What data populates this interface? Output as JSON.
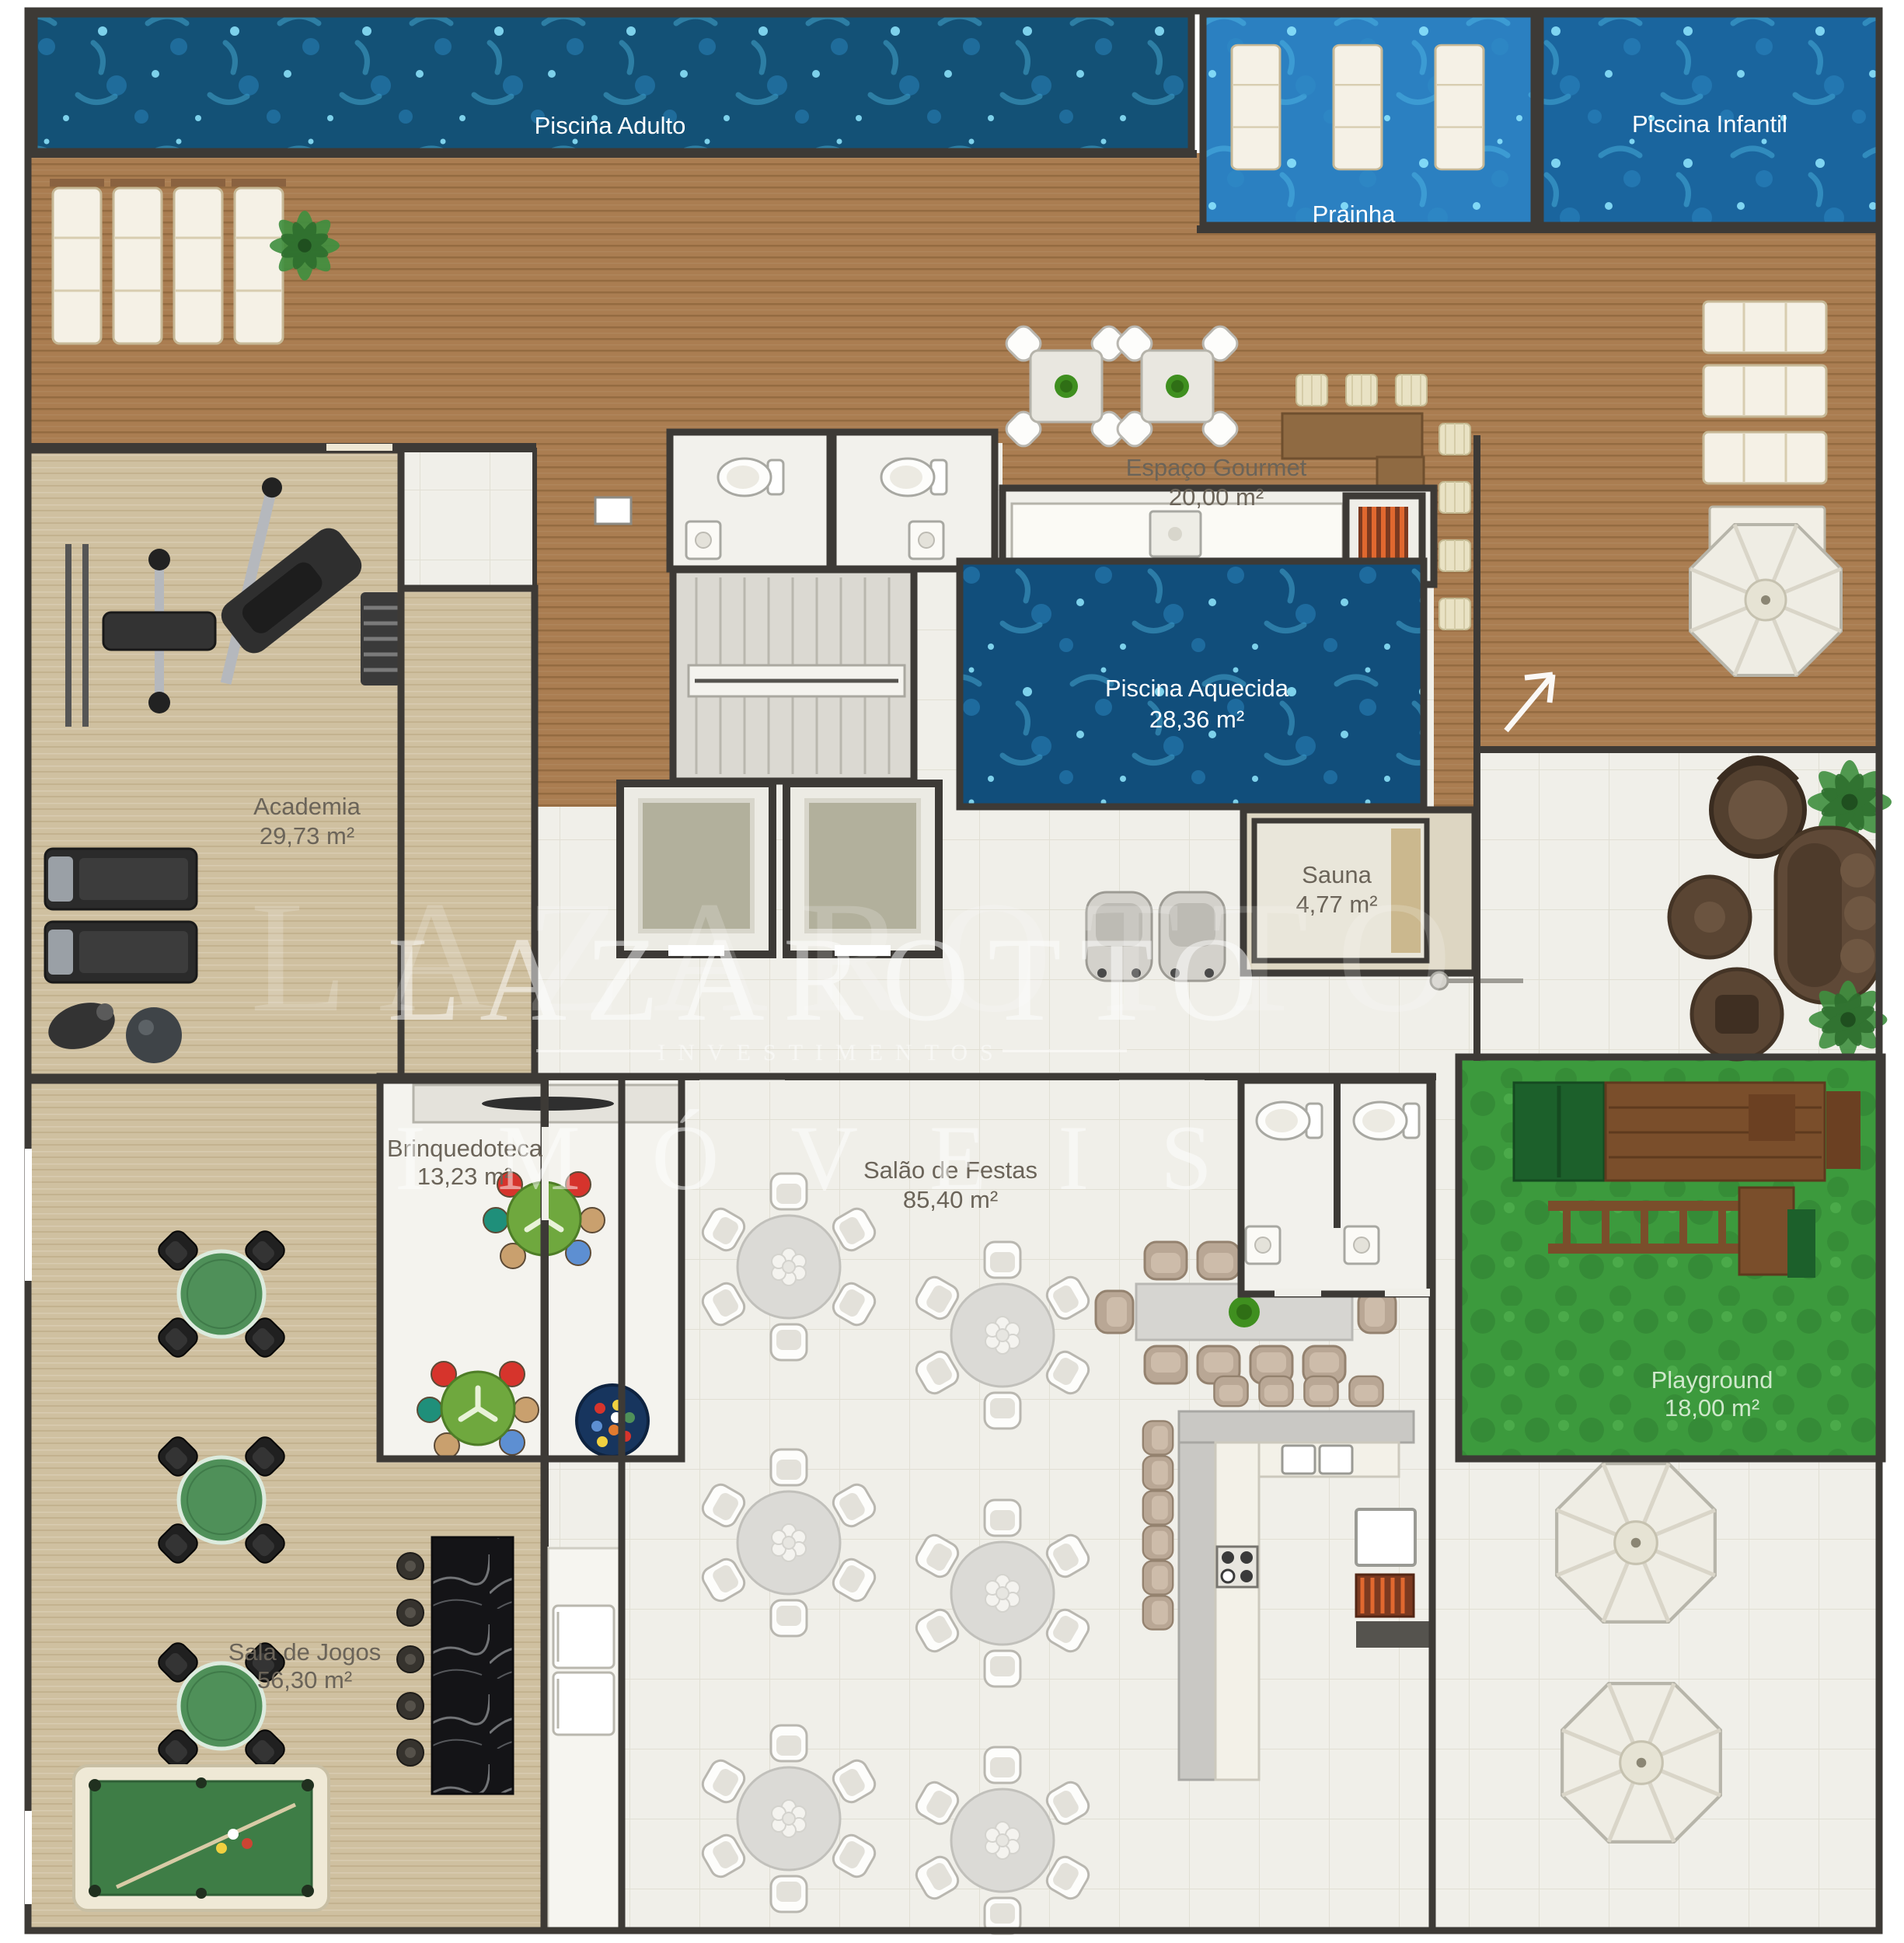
{
  "watermark": {
    "brand": "LAZAROTTO",
    "sub": "INVESTIMENTOS",
    "line2": "IMÓVEIS"
  },
  "labels": {
    "piscina_adulto": {
      "name": "Piscina Adulto"
    },
    "prainha": {
      "name": "Prainha"
    },
    "piscina_infantil": {
      "name": "Piscina Infantil"
    },
    "espaco_gourmet": {
      "name": "Espaço Gourmet",
      "area": "20,00 m²"
    },
    "academia": {
      "name": "Academia",
      "area": "29,73 m²"
    },
    "piscina_aquecida": {
      "name": "Piscina Aquecida",
      "area": "28,36 m²"
    },
    "sauna": {
      "name": "Sauna",
      "area": "4,77 m²"
    },
    "brinquedoteca": {
      "name": "Brinquedoteca",
      "area": "13,23 m²"
    },
    "salao_festas": {
      "name": "Salão de Festas",
      "area": "85,40 m²"
    },
    "playground": {
      "name": "Playground",
      "area": "18,00 m²"
    },
    "sala_jogos": {
      "name": "Sala de Jogos",
      "area": "56,30 m²"
    }
  },
  "colors": {
    "wall": "#3d3a36",
    "label": "#6b6459",
    "watermark": "#ffffff",
    "deck": "#aa7d51",
    "wood_light": "#cfc0a0",
    "tile": "#f0efe9",
    "grass": "#3c9a3d",
    "pool_adult": "#135176",
    "pool_prainha": "#2b80c1",
    "pool_infantil": "#1a659e",
    "pool_heated": "#114e7b",
    "green_table": "#4f9059",
    "marble": "#141417",
    "brown_furniture": "#5a4533"
  }
}
